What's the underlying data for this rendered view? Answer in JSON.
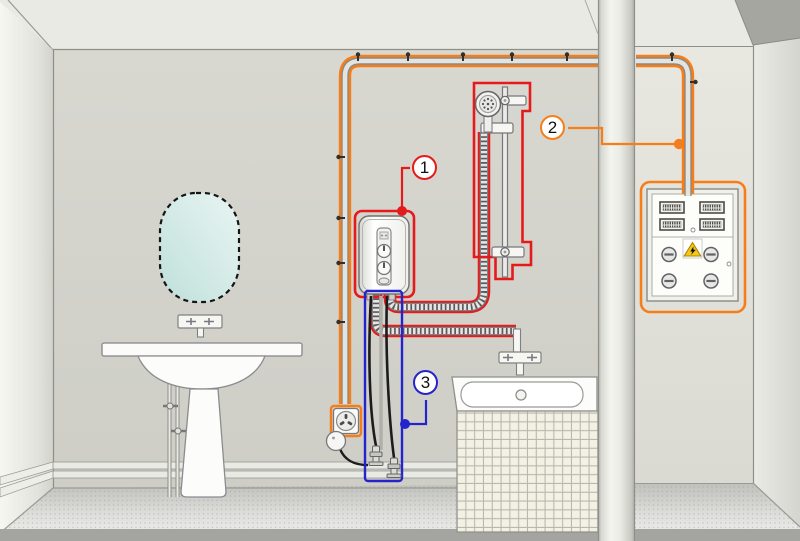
{
  "scene": {
    "description": "Bathroom installation diagram: electric instantaneous water heater with highlighted power and water connections"
  },
  "callouts": {
    "c1": {
      "label": "1",
      "target": "electric-instantaneous-water-heater",
      "color": "#e51a1a"
    },
    "c2": {
      "label": "2",
      "target": "power-supply-cable-to-distribution-panel",
      "color": "#f57e1b"
    },
    "c3": {
      "label": "3",
      "target": "water-supply-shutoff-valves",
      "color": "#2424cc"
    }
  },
  "colors": {
    "highlight_red": "#e51a1a",
    "highlight_orange": "#f57e1b",
    "highlight_blue": "#2424cc",
    "wall": "#d1d1ca",
    "ceiling": "#e9e9e3",
    "alcove_wall": "#e2e2da",
    "left_wall": "#f3f3ed",
    "floor_band": "#a4a4a1",
    "tile": "#f2f1e4",
    "warning_yellow": "#f6c61a"
  },
  "icons": {
    "warning": "high-voltage-warning-triangle-icon",
    "shower": "shower-head-icon",
    "socket": "power-socket-icon"
  }
}
